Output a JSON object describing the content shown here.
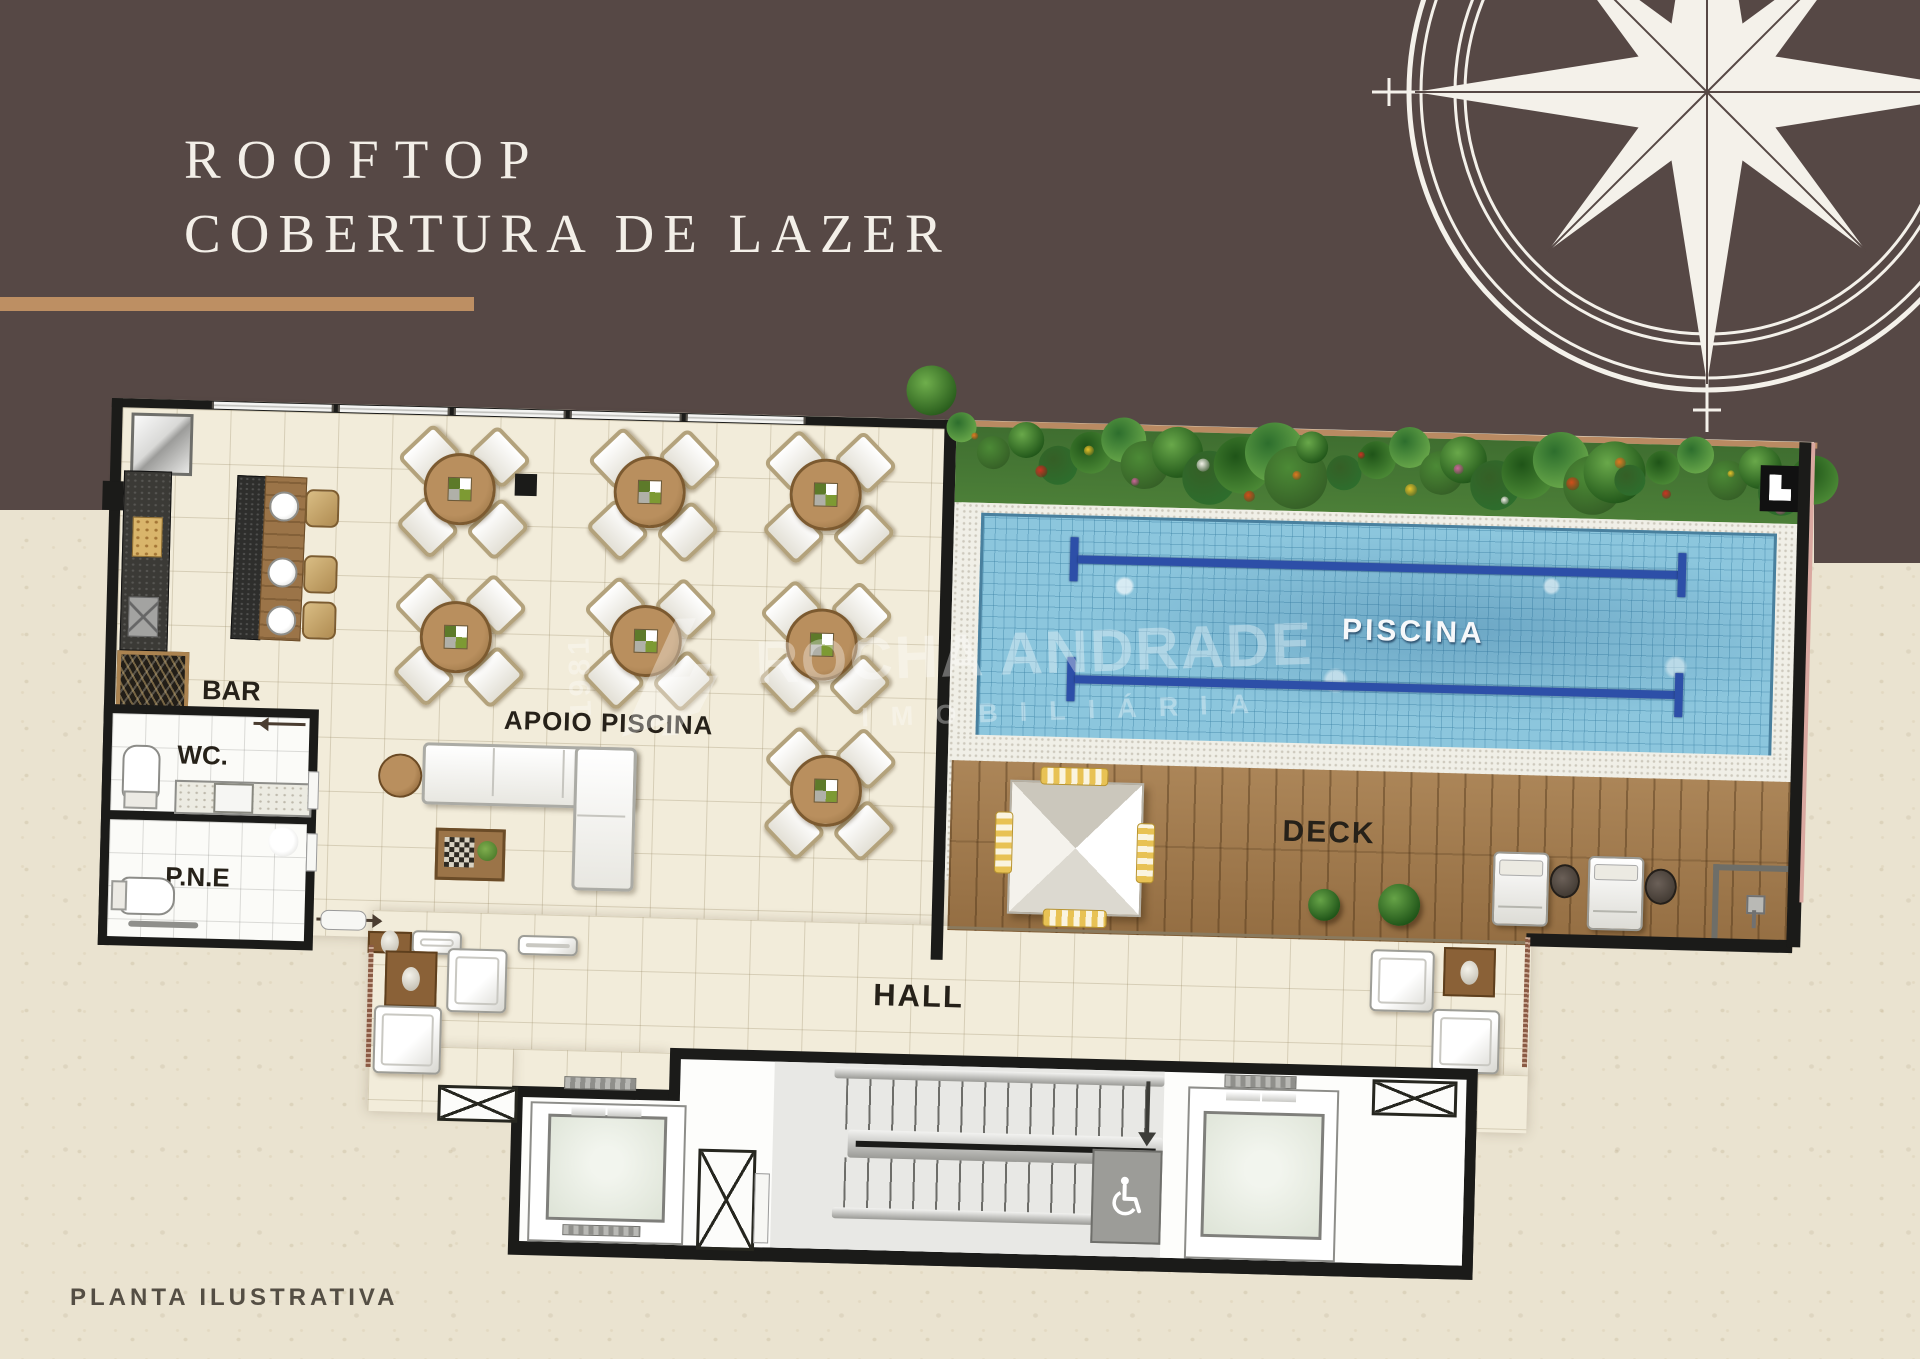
{
  "title": {
    "line1": "ROOFTOP",
    "line2": "COBERTURA DE LAZER"
  },
  "rooms": {
    "bar": "BAR",
    "wc": "WC.",
    "pne": "P.N.E",
    "apoio_piscina": "APOIO PISCINA",
    "piscina": "PISCINA",
    "deck": "DECK",
    "hall": "HALL"
  },
  "caption": "PLANTA ILUSTRATIVA",
  "watermark": {
    "brand": "ROCHA ANDRADE",
    "division": "IMOBILIÁRIA",
    "year": "1981"
  },
  "icons": {
    "compass": "compass-rose-icon",
    "accessibility": "wheelchair-icon",
    "stairs_direction": "down-arrow-icon"
  },
  "colors": {
    "header_brown": "#564845",
    "accent_stripe": "#bd8f63",
    "background_cream": "#eae3d0",
    "pool_blue": "#8cc6dd",
    "lane_blue": "#2d4fa8",
    "deck_wood": "#a0784a",
    "wall_black": "#1b1b19"
  }
}
